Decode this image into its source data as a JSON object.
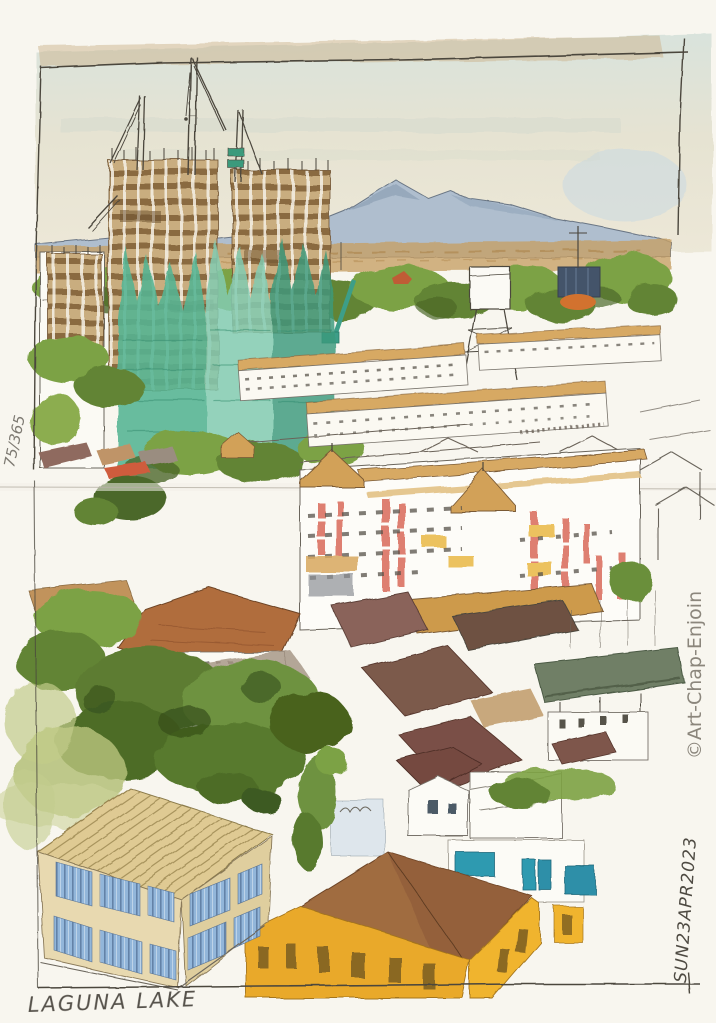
{
  "artwork": {
    "caption": "LAGUNA LAKE",
    "edition_number": "75/365",
    "date": "SUN23APR2023",
    "credit": "©Art-Chap-Enjoin"
  },
  "palette": {
    "paper": "#f8f6ef",
    "ink": "#4b463d",
    "sky_top": "#d9e3dc",
    "sky_low": "#ede8d8",
    "mountain_blue": "#a9bbce",
    "field_tan": "#c79f63",
    "foliage_green": "#7ca244",
    "foliage_dark": "#4c682a",
    "netting_teal": "#54b493",
    "scaffold_brown": "#8a6a40",
    "roof_tan": "#d7a964",
    "roof_terracotta": "#b06d3e",
    "roof_maroon": "#7a5046",
    "condo_red": "#d96a5a",
    "awning_yellow": "#ecc25f",
    "sage_building": "#6f7f66",
    "building_yellow": "#e9a92a",
    "cream_roof": "#dfca93",
    "window_blue": "#92b6da",
    "window_teal": "#2f9ab0",
    "crane_teal": "#3d9e88"
  }
}
